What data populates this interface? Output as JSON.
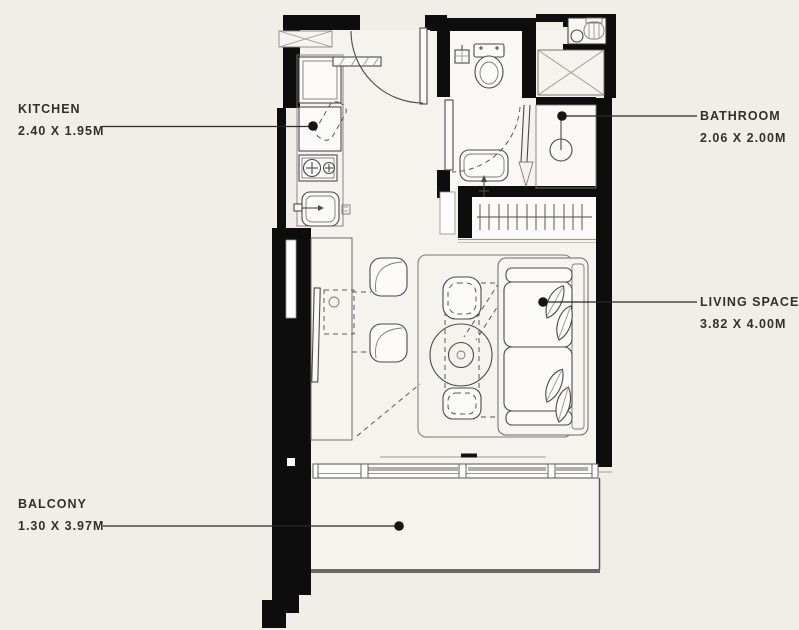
{
  "colors": {
    "background": "#f1eee8",
    "floor": "#f5f3ee",
    "wall": "#0d0d0d",
    "line": "#4a4a4a",
    "label_text": "#33302a"
  },
  "rooms": {
    "kitchen": {
      "label": "KITCHEN",
      "dimensions": "2.40 X 1.95M"
    },
    "bathroom": {
      "label": "BATHROOM",
      "dimensions": "2.06 X 2.00M"
    },
    "living_space": {
      "label": "LIVING SPACE",
      "dimensions": "3.82 X 4.00M"
    },
    "balcony": {
      "label": "BALCONY",
      "dimensions": "1.30 X 3.97M"
    }
  }
}
